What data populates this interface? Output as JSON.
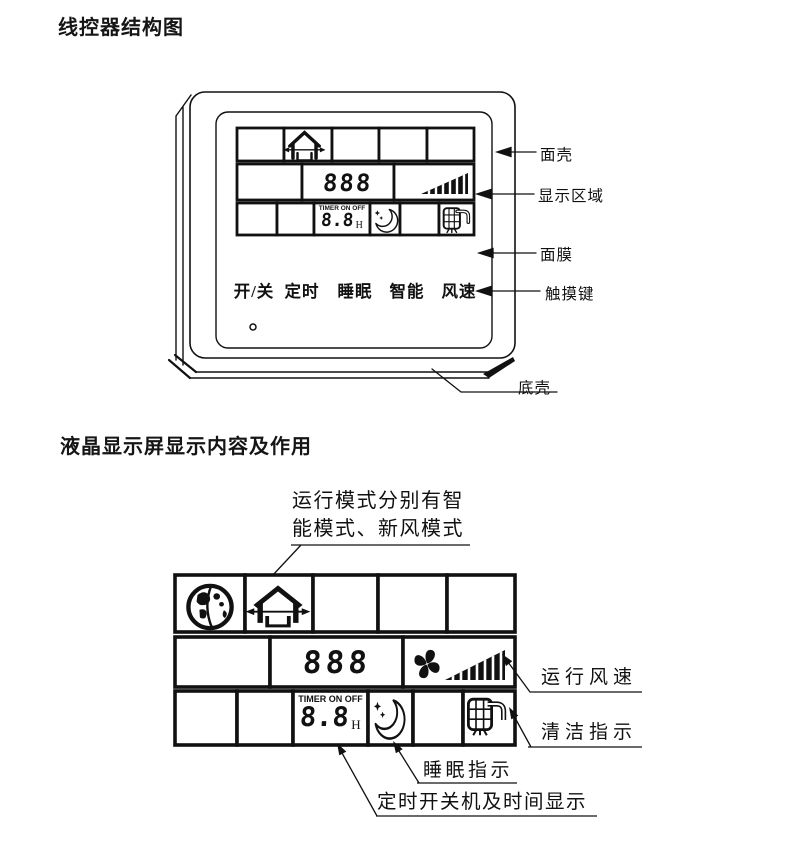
{
  "colors": {
    "ink": "#111111",
    "bg": "#ffffff"
  },
  "section1": {
    "title": "线控器结构图",
    "touch_keys": [
      "开/关",
      "定时",
      "睡眠",
      "智能",
      "风速"
    ],
    "callouts": {
      "front_shell": "面壳",
      "display_area": "显示区域",
      "membrane": "面膜",
      "touch_key": "触摸键",
      "bottom_shell": "底壳"
    },
    "lcd": {
      "mode_digits": "888",
      "timer_label": "TIMER ON OFF",
      "timer_value": "8.8",
      "timer_unit": "H"
    }
  },
  "section2": {
    "title": "液晶显示屏显示内容及作用",
    "mode_note_line1": "运行模式分别有智",
    "mode_note_line2": "能模式、新风模式",
    "callouts": {
      "fan_speed": "运行风速",
      "clean": "清洁指示",
      "sleep": "睡眠指示",
      "timer": "定时开关机及时间显示"
    },
    "lcd": {
      "mode_digits": "888",
      "timer_label": "TIMER ON OFF",
      "timer_value": "8.8",
      "timer_unit": "H"
    }
  },
  "icons": {
    "smart_mode": "globe-icon",
    "fresh_air_mode": "house-ventilation-icon",
    "fan": "fan-icon",
    "fan_speed_bars": "speed-triangle-icon",
    "sleep": "moon-stars-icon",
    "clean": "filter-clean-icon",
    "power_indicator": "led-dot"
  }
}
